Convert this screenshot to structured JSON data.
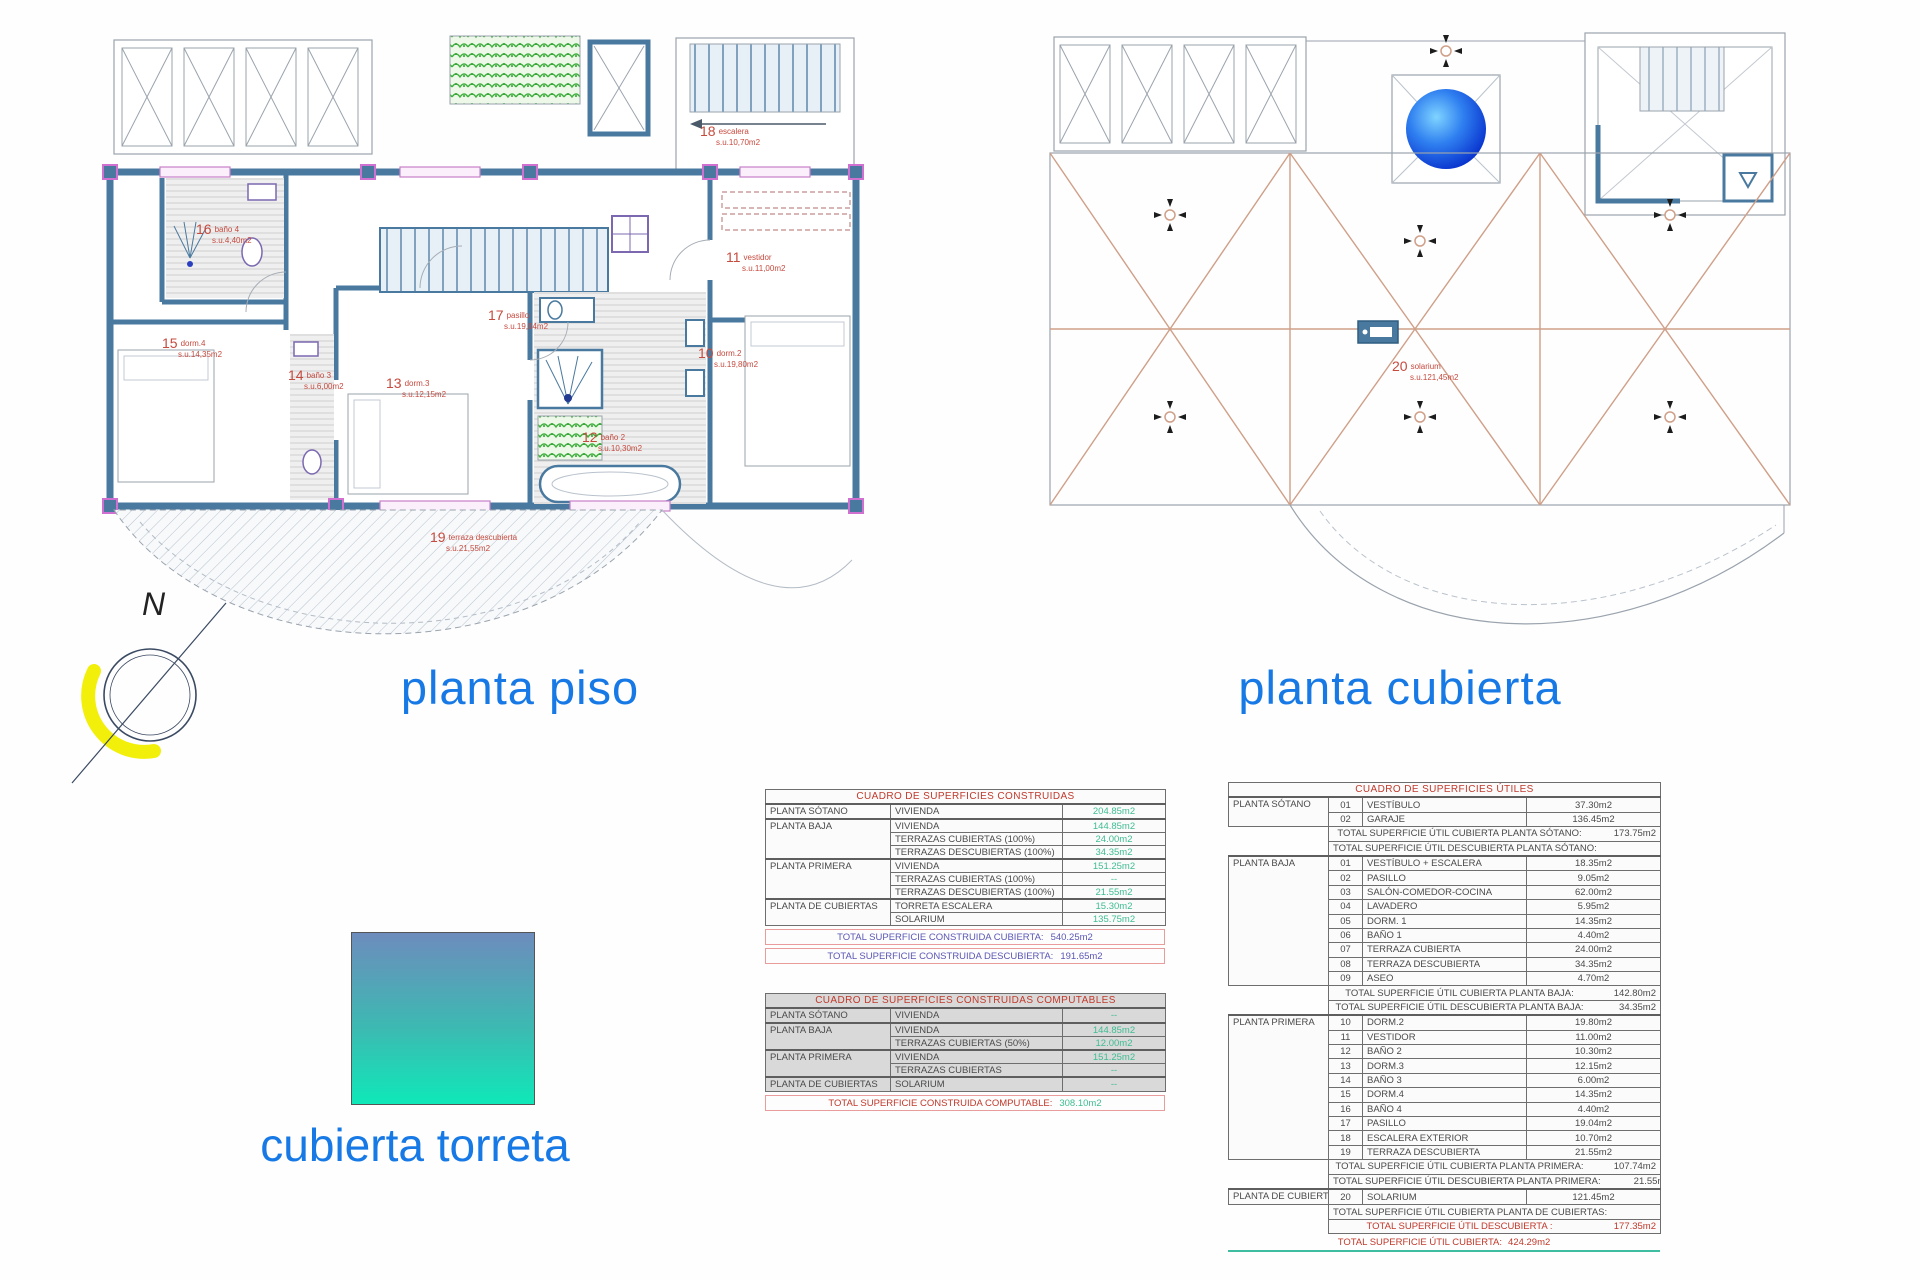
{
  "titles": {
    "left_plan": "planta piso",
    "right_plan": "planta cubierta",
    "torreta": "cubierta torreta"
  },
  "compass": {
    "label": "N"
  },
  "colors": {
    "title_blue": "#1779e6",
    "label_red": "#c64a3e",
    "value_green": "#3fbd92",
    "total_purple": "#5b57b5",
    "wall_blue": "#49799f",
    "roof_tan": "#cf9f88",
    "torreta_top": "#6d8cbd",
    "torreta_bottom": "#0fe8b8"
  },
  "plans": {
    "piso": {
      "rooms": [
        {
          "num": "16",
          "name": "baño 4",
          "area": "s.u.4,40m2"
        },
        {
          "num": "18",
          "name": "escalera",
          "area": "s.u.10,70m2"
        },
        {
          "num": "11",
          "name": "vestidor",
          "area": "s.u.11,00m2"
        },
        {
          "num": "17",
          "name": "pasillo",
          "area": "s.u.19,04m2"
        },
        {
          "num": "15",
          "name": "dorm.4",
          "area": "s.u.14,35m2"
        },
        {
          "num": "14",
          "name": "baño 3",
          "area": "s.u.6,00m2"
        },
        {
          "num": "13",
          "name": "dorm.3",
          "area": "s.u.12,15m2"
        },
        {
          "num": "10",
          "name": "dorm.2",
          "area": "s.u.19,80m2"
        },
        {
          "num": "12",
          "name": "baño 2",
          "area": "s.u.10,30m2"
        },
        {
          "num": "19",
          "name": "terraza descubierta",
          "area": "s.u.21,55m2"
        }
      ]
    },
    "cubierta": {
      "rooms": [
        {
          "num": "20",
          "name": "solarium",
          "area": "s.u.121,45m2"
        }
      ]
    }
  },
  "tables": {
    "construidas": {
      "title": "CUADRO DE SUPERFICIES CONSTRUIDAS",
      "rows": [
        {
          "floor": "PLANTA SÓTANO",
          "span": 1,
          "room": "VIVIENDA",
          "value": "204.85m2",
          "g": true
        },
        {
          "floor": "PLANTA BAJA",
          "span": 3,
          "room": "VIVIENDA",
          "value": "144.85m2",
          "g": true
        },
        {
          "room": "TERRAZAS CUBIERTAS (100%)",
          "value": "24.00m2"
        },
        {
          "room": "TERRAZAS DESCUBIERTAS (100%)",
          "value": "34.35m2"
        },
        {
          "floor": "PLANTA PRIMERA",
          "span": 3,
          "room": "VIVIENDA",
          "value": "151.25m2",
          "g": true
        },
        {
          "room": "TERRAZAS CUBIERTAS (100%)",
          "value": "--"
        },
        {
          "room": "TERRAZAS DESCUBIERTAS (100%)",
          "value": "21.55m2"
        },
        {
          "floor": "PLANTA DE CUBIERTAS",
          "span": 2,
          "room": "TORRETA ESCALERA",
          "value": "15.30m2",
          "g": true
        },
        {
          "room": "SOLARIUM",
          "value": "135.75m2"
        }
      ],
      "totals": [
        {
          "label": "TOTAL SUPERFICIE CONSTRUIDA CUBIERTA:",
          "value": "540.25m2"
        },
        {
          "label": "TOTAL SUPERFICIE CONSTRUIDA DESCUBIERTA:",
          "value": "191.65m2"
        }
      ]
    },
    "computables": {
      "title": "CUADRO DE SUPERFICIES CONSTRUIDAS COMPUTABLES",
      "rows": [
        {
          "floor": "PLANTA SÓTANO",
          "span": 1,
          "room": "VIVIENDA",
          "value": "--",
          "g": true
        },
        {
          "floor": "PLANTA BAJA",
          "span": 2,
          "room": "VIVIENDA",
          "value": "144.85m2",
          "g": true
        },
        {
          "room": "TERRAZAS CUBIERTAS (50%)",
          "value": "12.00m2"
        },
        {
          "floor": "PLANTA PRIMERA",
          "span": 2,
          "room": "VIVIENDA",
          "value": "151.25m2",
          "g": true
        },
        {
          "room": "TERRAZAS CUBIERTAS",
          "value": "--"
        },
        {
          "floor": "PLANTA DE CUBIERTAS",
          "span": 1,
          "room": "SOLARIUM",
          "value": "--",
          "g": true
        }
      ],
      "totals": [
        {
          "label": "TOTAL SUPERFICIE CONSTRUIDA COMPUTABLE:",
          "value": "308.10m2"
        }
      ]
    },
    "utiles": {
      "title": "CUADRO DE SUPERFICIES ÚTILES",
      "rows": [
        {
          "floor": "PLANTA SÓTANO",
          "span": 2,
          "num": "01",
          "room": "VESTÍBULO",
          "value": "37.30m2",
          "g": true
        },
        {
          "num": "02",
          "room": "GARAJE",
          "value": "136.45m2"
        },
        {
          "total": "TOTAL SUPERFICIE ÚTIL CUBIERTA PLANTA SÓTANO:",
          "value": "173.75m2"
        },
        {
          "total": "TOTAL SUPERFICIE ÚTIL DESCUBIERTA PLANTA SÓTANO:",
          "value": "--"
        },
        {
          "floor": "PLANTA BAJA",
          "span": 9,
          "num": "01",
          "room": "VESTÍBULO + ESCALERA",
          "value": "18.35m2",
          "g": true
        },
        {
          "num": "02",
          "room": "PASILLO",
          "value": "9.05m2"
        },
        {
          "num": "03",
          "room": "SALÓN-COMEDOR-COCINA",
          "value": "62.00m2"
        },
        {
          "num": "04",
          "room": "LAVADERO",
          "value": "5.95m2"
        },
        {
          "num": "05",
          "room": "DORM. 1",
          "value": "14.35m2"
        },
        {
          "num": "06",
          "room": "BAÑO 1",
          "value": "4.40m2"
        },
        {
          "num": "07",
          "room": "TERRAZA CUBIERTA",
          "value": "24.00m2"
        },
        {
          "num": "08",
          "room": "TERRAZA DESCUBIERTA",
          "value": "34.35m2"
        },
        {
          "num": "09",
          "room": "ASEO",
          "value": "4.70m2"
        },
        {
          "total": "TOTAL SUPERFICIE ÚTIL CUBIERTA PLANTA BAJA:",
          "value": "142.80m2"
        },
        {
          "total": "TOTAL SUPERFICIE ÚTIL DESCUBIERTA PLANTA BAJA:",
          "value": "34.35m2"
        },
        {
          "floor": "PLANTA PRIMERA",
          "span": 10,
          "num": "10",
          "room": "DORM.2",
          "value": "19.80m2",
          "g": true
        },
        {
          "num": "11",
          "room": "VESTIDOR",
          "value": "11.00m2"
        },
        {
          "num": "12",
          "room": "BAÑO 2",
          "value": "10.30m2"
        },
        {
          "num": "13",
          "room": "DORM.3",
          "value": "12.15m2"
        },
        {
          "num": "14",
          "room": "BAÑO 3",
          "value": "6.00m2"
        },
        {
          "num": "15",
          "room": "DORM.4",
          "value": "14.35m2"
        },
        {
          "num": "16",
          "room": "BAÑO 4",
          "value": "4.40m2"
        },
        {
          "num": "17",
          "room": "PASILLO",
          "value": "19.04m2"
        },
        {
          "num": "18",
          "room": "ESCALERA EXTERIOR",
          "value": "10.70m2"
        },
        {
          "num": "19",
          "room": "TERRAZA DESCUBIERTA",
          "value": "21.55m2"
        },
        {
          "total": "TOTAL SUPERFICIE ÚTIL CUBIERTA PLANTA PRIMERA:",
          "value": "107.74m2"
        },
        {
          "total": "TOTAL SUPERFICIE ÚTIL DESCUBIERTA PLANTA PRIMERA:",
          "value": "21.55m2"
        },
        {
          "floor": "PLANTA DE CUBIERTAS",
          "span": 1,
          "num": "20",
          "room": "SOLARIUM",
          "value": "121.45m2",
          "g": true
        },
        {
          "total": "TOTAL SUPERFICIE ÚTIL CUBIERTA PLANTA DE CUBIERTAS:",
          "value": "--"
        },
        {
          "total": "TOTAL SUPERFICIE ÚTIL DESCUBIERTA :",
          "value": "177.35m2",
          "red": true
        }
      ],
      "final_total": {
        "label": "TOTAL SUPERFICIE ÚTIL CUBIERTA:",
        "value": "424.29m2"
      }
    }
  }
}
